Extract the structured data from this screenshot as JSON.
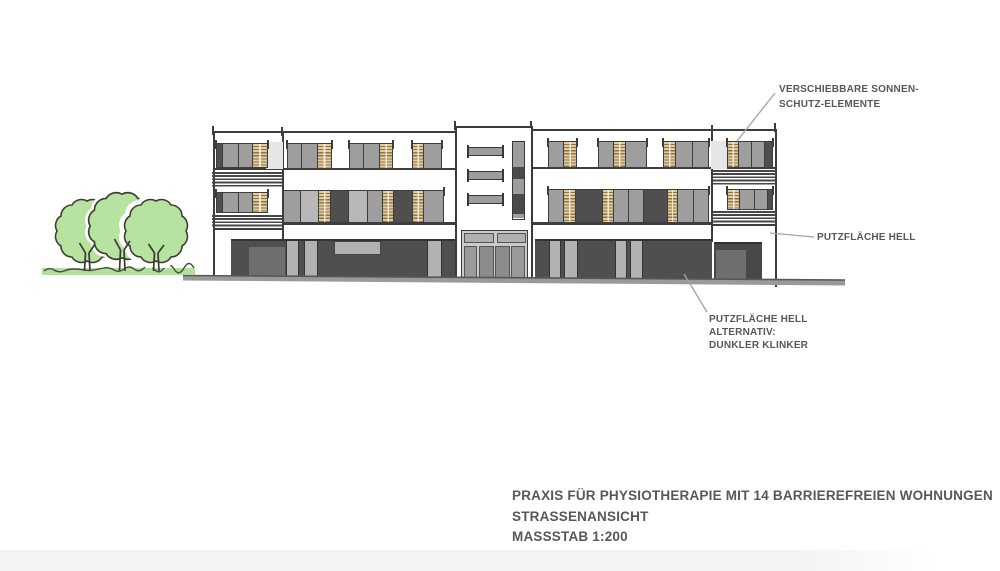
{
  "drawing": {
    "type": "architectural street elevation",
    "building_use": "physiotherapy practice with 14 barrier-free apartments"
  },
  "title_block": {
    "line1": "PRAXIS FÜR PHYSIOTHERAPIE MIT 14 BARRIEREFREIEN WOHNUNGEN",
    "line2": "STRASSENANSICHT",
    "line3": "MASSSTAB 1:200"
  },
  "annotations": {
    "sun_protection": {
      "line1": "VERSCHIEBBARE SONNEN-",
      "line2": "SCHUTZ-ELEMENTE"
    },
    "plaster_light": {
      "line1": "PUTZFLÄCHE HELL"
    },
    "plaster_alt": {
      "line1": "PUTZFLÄCHE HELL",
      "line2": "ALTERNATIV:",
      "line3": "DUNKLER KLINKER"
    }
  },
  "colors": {
    "facade_white": "#ffffff",
    "panel_gray": "#9e9e9e",
    "panel_light_gray": "#b8b8b8",
    "panel_dark": "#4f4f4f",
    "louver_tan": "#e3cb97",
    "louver_stripe": "#8d7550",
    "storefront_dark": "#4f4f4f",
    "storefront_inner": "#6e6e6e",
    "pilaster_light": "#b2b2b2",
    "line_dark": "#3d3d3d",
    "tree_green": "#b7e3a1",
    "grass_green": "#aee29a",
    "tree_outline": "#3e3e35",
    "sidewalk_gray": "#9a9a9a",
    "text_gray": "#57585a",
    "leader_gray": "#a3a3a3"
  },
  "facade": {
    "window_groups": [
      {
        "x": 216,
        "y": 143,
        "h": 25,
        "p": [
          [
            "d",
            6
          ],
          [
            "g",
            16
          ],
          [
            "g",
            14
          ],
          [
            "t",
            14
          ]
        ]
      },
      {
        "x": 287,
        "y": 143,
        "h": 26,
        "p": [
          [
            "g",
            14
          ],
          [
            "g",
            16
          ],
          [
            "t",
            13
          ]
        ]
      },
      {
        "x": 349,
        "y": 143,
        "h": 26,
        "p": [
          [
            "g",
            14
          ],
          [
            "g",
            16
          ],
          [
            "t",
            12
          ]
        ]
      },
      {
        "x": 412,
        "y": 143,
        "h": 26,
        "p": [
          [
            "t",
            11
          ],
          [
            "g",
            17
          ]
        ]
      },
      {
        "x": 548,
        "y": 141,
        "h": 27,
        "p": [
          [
            "g",
            15
          ],
          [
            "t",
            12
          ]
        ]
      },
      {
        "x": 598,
        "y": 141,
        "h": 27,
        "p": [
          [
            "g",
            15
          ],
          [
            "t",
            12
          ],
          [
            "g",
            20
          ]
        ]
      },
      {
        "x": 663,
        "y": 141,
        "h": 27,
        "p": [
          [
            "t",
            12
          ],
          [
            "g",
            17
          ],
          [
            "g",
            15
          ]
        ]
      },
      {
        "x": 727,
        "y": 141,
        "h": 27,
        "p": [
          [
            "t",
            11
          ],
          [
            "g",
            13
          ],
          [
            "g",
            13
          ],
          [
            "d",
            7
          ]
        ]
      },
      {
        "x": 216,
        "y": 192,
        "h": 21,
        "p": [
          [
            "d",
            6
          ],
          [
            "g",
            16
          ],
          [
            "g",
            14
          ],
          [
            "t",
            14
          ]
        ]
      },
      {
        "x": 283,
        "y": 190,
        "h": 33,
        "p": [
          [
            "g",
            17
          ],
          [
            "l",
            18
          ],
          [
            "t",
            12
          ],
          [
            "d",
            18
          ],
          [
            "l",
            19
          ],
          [
            "g",
            15
          ],
          [
            "t",
            11
          ],
          [
            "d",
            19
          ],
          [
            "t",
            11
          ],
          [
            "g",
            19
          ]
        ]
      },
      {
        "x": 548,
        "y": 189,
        "h": 34,
        "p": [
          [
            "g",
            15
          ],
          [
            "t",
            12
          ],
          [
            "d",
            27
          ],
          [
            "t",
            11
          ],
          [
            "g",
            15
          ],
          [
            "g",
            15
          ],
          [
            "d",
            24
          ],
          [
            "t",
            10
          ],
          [
            "g",
            16
          ],
          [
            "g",
            14
          ]
        ]
      },
      {
        "x": 727,
        "y": 189,
        "h": 21,
        "p": [
          [
            "t",
            12
          ],
          [
            "g",
            15
          ],
          [
            "g",
            13
          ],
          [
            "d",
            4
          ]
        ]
      }
    ],
    "railings": [
      {
        "x": 212,
        "y": 172,
        "w": 70,
        "h": 15
      },
      {
        "x": 212,
        "y": 215,
        "w": 70,
        "h": 13
      },
      {
        "x": 713,
        "y": 170,
        "w": 63,
        "h": 16
      },
      {
        "x": 713,
        "y": 211,
        "w": 63,
        "h": 13
      }
    ],
    "wedges": [
      {
        "x": 266,
        "y": 142,
        "w": 17,
        "h": 27
      },
      {
        "x": 711,
        "y": 141,
        "w": 16,
        "h": 28
      },
      {
        "x": 458,
        "y": 139,
        "w": 12,
        "h": 92
      }
    ],
    "lines": [
      {
        "x": 213,
        "y": 131,
        "w": 244,
        "h": 2
      },
      {
        "x": 531,
        "y": 129,
        "w": 246,
        "h": 2
      },
      {
        "x": 213,
        "y": 131,
        "w": 2,
        "h": 149
      },
      {
        "x": 775,
        "y": 129,
        "w": 2,
        "h": 158
      },
      {
        "x": 282,
        "y": 131,
        "w": 1.5,
        "h": 108
      },
      {
        "x": 711,
        "y": 129,
        "w": 1.5,
        "h": 113
      },
      {
        "x": 213,
        "y": 168,
        "w": 244,
        "h": 1.5
      },
      {
        "x": 531,
        "y": 167,
        "w": 246,
        "h": 1.5
      },
      {
        "x": 283,
        "y": 222,
        "w": 174,
        "h": 2.5
      },
      {
        "x": 213,
        "y": 228,
        "w": 70,
        "h": 2
      },
      {
        "x": 531,
        "y": 222,
        "w": 181,
        "h": 2.5
      },
      {
        "x": 711,
        "y": 224,
        "w": 66,
        "h": 2
      }
    ],
    "ticks": [
      {
        "x": 212,
        "y": 126
      },
      {
        "x": 281,
        "y": 127
      },
      {
        "x": 454,
        "y": 121
      },
      {
        "x": 530,
        "y": 121
      },
      {
        "x": 774,
        "y": 123
      },
      {
        "x": 711,
        "y": 125
      }
    ]
  },
  "ground_floor": {
    "bases": [
      {
        "x": 231,
        "y": 239,
        "w": 226,
        "h": 41,
        "c": "#4f4f4f"
      },
      {
        "x": 535,
        "y": 239,
        "w": 177,
        "h": 41,
        "c": "#4f4f4f"
      },
      {
        "x": 714,
        "y": 242,
        "w": 48,
        "h": 38,
        "c": "#484848"
      }
    ],
    "inner_panels": [
      {
        "x": 249,
        "y": 247,
        "w": 36,
        "h": 33
      },
      {
        "x": 716,
        "y": 250,
        "w": 30,
        "h": 30
      }
    ],
    "pilasters": [
      {
        "x": 286,
        "w": 13
      },
      {
        "x": 304,
        "w": 14
      },
      {
        "x": 427,
        "w": 15
      },
      {
        "x": 549,
        "w": 12
      },
      {
        "x": 564,
        "w": 14
      },
      {
        "x": 615,
        "w": 12
      },
      {
        "x": 630,
        "w": 13
      }
    ],
    "pilaster_y": 241,
    "pilaster_h": 38,
    "transom_window": {
      "x": 334,
      "y": 241,
      "w": 47,
      "h": 14
    }
  },
  "tower": {
    "box": {
      "x": 455,
      "y": 126,
      "w": 78,
      "h": 156
    },
    "bars": [
      {
        "x": 468,
        "y": 147
      },
      {
        "x": 468,
        "y": 171
      },
      {
        "x": 468,
        "y": 195
      }
    ],
    "bar_w": 35,
    "bar_h": 9,
    "strip": {
      "x": 512,
      "y": 141,
      "w": 13,
      "h": 79
    },
    "strip_segments": [
      [
        "g",
        25
      ],
      [
        "d",
        12
      ],
      [
        "g",
        15
      ],
      [
        "d",
        20
      ],
      [
        "g",
        4
      ]
    ],
    "entrance_frame": {
      "x": 461,
      "y": 230,
      "w": 67,
      "h": 52
    },
    "transoms": [
      {
        "x": 464,
        "y": 233,
        "w": 30,
        "h": 10
      },
      {
        "x": 497,
        "y": 233,
        "w": 29,
        "h": 10
      }
    ],
    "door_parts": [
      {
        "x": 464,
        "y": 246,
        "w": 13,
        "h": 34,
        "c": "#9a9a9a"
      },
      {
        "x": 479,
        "y": 246,
        "w": 15,
        "h": 34,
        "c": "#8c8c8c"
      },
      {
        "x": 495,
        "y": 246,
        "w": 15,
        "h": 34,
        "c": "#8c8c8c"
      },
      {
        "x": 511,
        "y": 246,
        "w": 14,
        "h": 34,
        "c": "#9a9a9a"
      }
    ]
  }
}
